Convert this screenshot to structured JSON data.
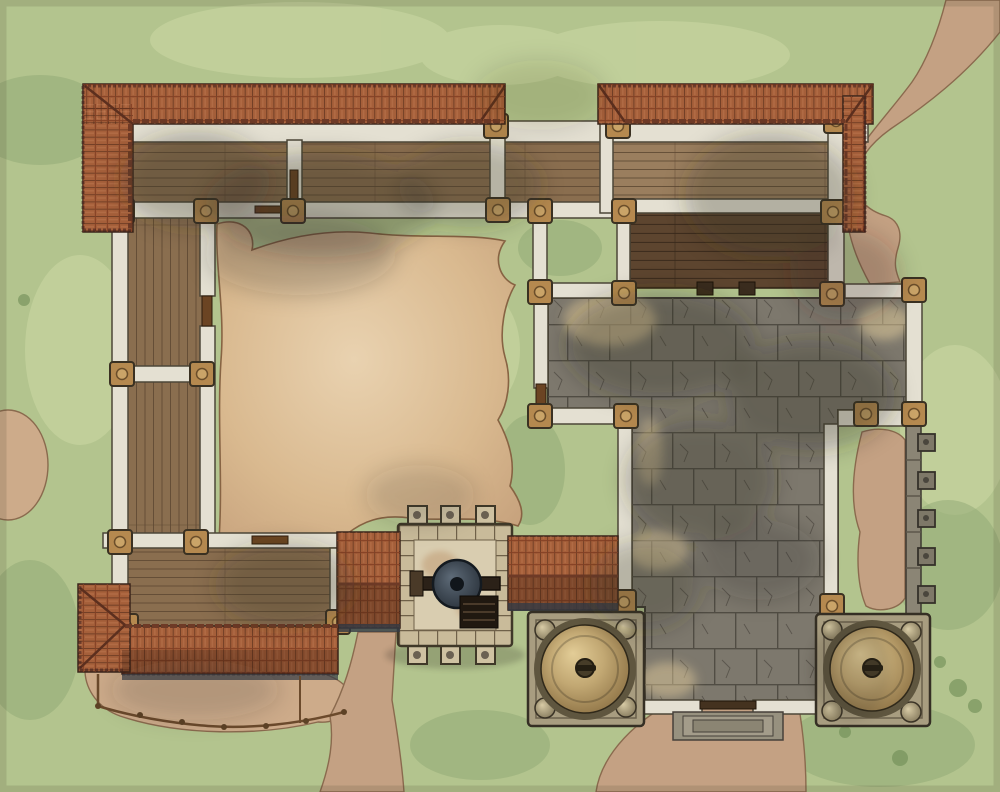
{
  "map": {
    "kind": "top-down fantasy battle map",
    "subject": "walled monastery courtyard with gatehouse winch and twin dome towers"
  },
  "features": {
    "structures": [
      "north wing rooms",
      "west wing rooms",
      "south-west wing",
      "raised wooden deck",
      "flagstone courtyard",
      "inner dirt courtyard",
      "gatehouse with winch",
      "west gate roof",
      "east gate roof",
      "left dome tower",
      "right dome tower",
      "buttressed east wall",
      "wooden fence",
      "entry steps"
    ],
    "dome_towers": 2,
    "gatehouse_corner_posts": 6,
    "east_wall_buttresses": 5,
    "trails": [
      "north-east trail",
      "south road",
      "south-west trail"
    ]
  },
  "palette": {
    "grass": "#b3c48e",
    "grassLight": "#ccd8a4",
    "grassDark": "#8fa873",
    "grassDeep": "#6e8c55",
    "dirt": "#d9b991",
    "dirtEdge": "#876343",
    "path": "#c4a183",
    "pathEdge": "#8a6a4e",
    "yard": "#cdab8a",
    "paving": "#7d786d",
    "pavingLine": "#514d44",
    "pavingDark": "#3e3a31",
    "wall": "#e4e0d2",
    "wallStroke": "#4d4738",
    "pillar": "#b5894f",
    "pillarDark": "#3a3122",
    "wood": "#8a6e4f",
    "woodLight": "#9a7e5e",
    "woodLine": "#5e4832",
    "deck": "#5d452f",
    "deckLine": "#3a2a1b",
    "roof": "#a55f3a",
    "roofLine": "#4b2817",
    "roofRidge": "#6e3a26",
    "roofShade": "#3a1f12",
    "eaveShadow": "#343b45",
    "ghStone": "#c9bb9a",
    "ghFloor": "#d9cdb0",
    "platform": "#a89d80",
    "domeLight": "#e3cd97",
    "domeMid": "#c2a873",
    "domeDark": "#63512f",
    "domeRim": "#5f563f",
    "winch": "#2a323b",
    "roughWall": "#8b8575",
    "buttress": "#7e7868",
    "fence": "#6b4a2c",
    "door": "#6b4423",
    "shadow": "#2e2a22",
    "sun": "#ecd3a0",
    "stepStone": "#97917f"
  }
}
